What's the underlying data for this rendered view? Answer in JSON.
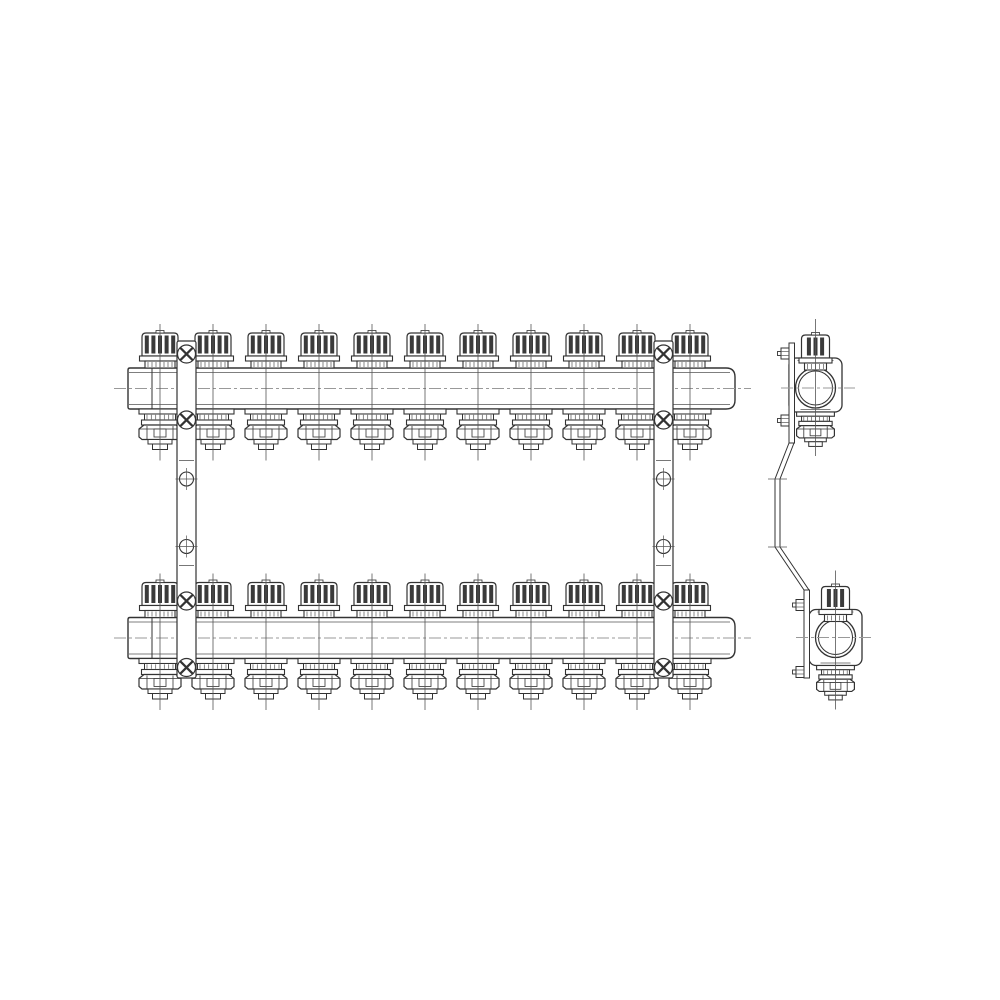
{
  "drawing": {
    "subject": "manifold-assembly-technical-drawing",
    "views": [
      "front-view",
      "side-view"
    ],
    "colors": {
      "background": "#ffffff",
      "line": "#333333",
      "thin_line": "#555555",
      "knurl": "#3a3a3a",
      "centerline": "#999999"
    },
    "front_view": {
      "valves_per_bar": 11,
      "first_valve_x": 160,
      "valve_spacing": 53,
      "bar_left": 128,
      "bar_right": 735,
      "bars": [
        {
          "name": "top-manifold-bar",
          "top": 368,
          "bottom": 409
        },
        {
          "name": "bottom-manifold-bar",
          "top": 617.5,
          "bottom": 658.5
        }
      ],
      "centerline_y": [
        388.5,
        638
      ],
      "centerline_x_range": [
        114,
        751
      ],
      "brackets": {
        "x_centers": [
          186.5,
          663.5
        ],
        "top": 341,
        "bottom": 678,
        "width": 19,
        "screw_y": [
          354,
          420,
          601,
          667.5
        ],
        "screw_r": 9,
        "hole_y": [
          479,
          546.5
        ],
        "hole_r": 7,
        "step_line_y": [
          460.5,
          565.5
        ]
      }
    },
    "side_view": {
      "bore_outer_r": 20,
      "bore_inner_r": 17,
      "units": [
        {
          "name": "side-view-top-manifold",
          "cx": 815.5,
          "bore_cy": 388,
          "body_top": 358,
          "body_bottom": 412,
          "strip_x": 789,
          "strip_top": 343,
          "strip_bottom": 443,
          "screw_y": [
            353.5,
            420.5
          ],
          "centerline_x": [
            781,
            855
          ]
        },
        {
          "name": "side-view-bottom-manifold",
          "cx": 835.5,
          "bore_cy": 637.5,
          "body_top": 609.5,
          "body_bottom": 665.5,
          "strip_x": 804,
          "strip_top": 590,
          "strip_bottom": 678,
          "screw_y": [
            605,
            672
          ],
          "centerline_x": [
            796,
            874
          ]
        }
      ],
      "strap_points": [
        [
          791.5,
          443
        ],
        [
          777.5,
          479
        ],
        [
          777.5,
          547
        ],
        [
          806.5,
          590
        ]
      ],
      "strap_half_width": 2.5,
      "strap_tick_y": [
        479,
        547
      ]
    }
  }
}
